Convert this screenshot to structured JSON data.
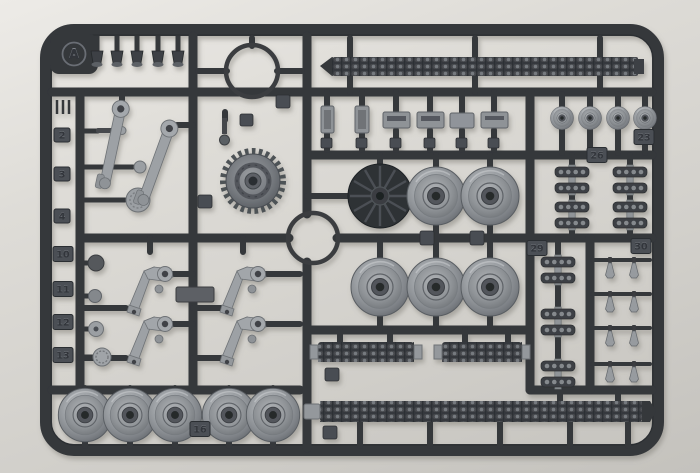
{
  "scene": {
    "description": "Photograph of a dark grey injection-moulded plastic model sprue (parts tree) for a tank kit, runner letter A, holding tracks, road wheels, drive sprocket, spoked idler, suspension swing arms and bell cranks, on a plain light grey backdrop"
  },
  "colors": {
    "background_top": "#edebe7",
    "background_bottom": "#c4c2bd",
    "sprue_plastic": "#34373b",
    "sprue_highlight": "#55595e",
    "part_silver": "#9b9fa3",
    "track_dark": "#3a3d41",
    "tab_face": "#4b4f54"
  },
  "tabs": {
    "gate_letter": "A",
    "numbers": [
      "2",
      "3",
      "4",
      "10",
      "11",
      "12",
      "13",
      "16",
      "23",
      "26",
      "29",
      "30"
    ]
  }
}
